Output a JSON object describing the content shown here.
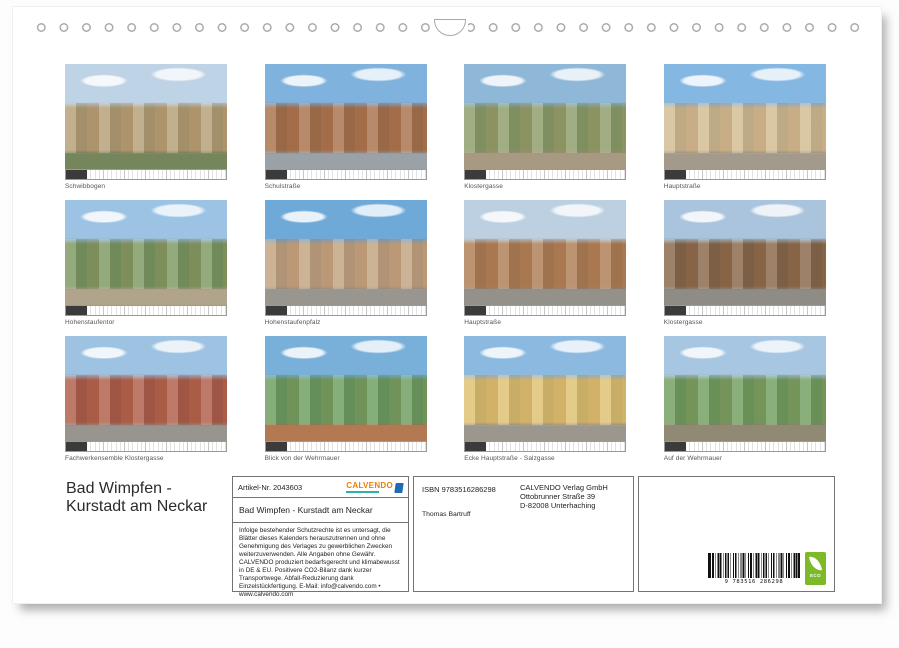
{
  "grid": {
    "items": [
      {
        "caption": "Schwibbogen",
        "palette": [
          "#bfd3e6",
          "#b5a077",
          "#75865c"
        ]
      },
      {
        "caption": "Schulstraße",
        "palette": [
          "#7fb2dd",
          "#a9744f",
          "#9aa2a8"
        ]
      },
      {
        "caption": "Klostergasse",
        "palette": [
          "#8fb8d8",
          "#8f9f6b",
          "#a89a82"
        ]
      },
      {
        "caption": "Hauptstraße",
        "palette": [
          "#85b7e3",
          "#d3bd94",
          "#a39a8c"
        ]
      },
      {
        "caption": "Hohenstaufentor",
        "palette": [
          "#9cc3e4",
          "#7e9a63",
          "#b0a48c"
        ]
      },
      {
        "caption": "Hohenstaufenpfalz",
        "palette": [
          "#6ea9d8",
          "#c4a582",
          "#99958f"
        ]
      },
      {
        "caption": "Hauptstraße",
        "palette": [
          "#bcd0e2",
          "#b08057",
          "#94908a"
        ]
      },
      {
        "caption": "Klostergasse",
        "palette": [
          "#aac4dd",
          "#8a6a4c",
          "#8f8c86"
        ]
      },
      {
        "caption": "Fachwerkensemble Klostergasse",
        "palette": [
          "#9dc2e2",
          "#b2604c",
          "#98948e"
        ]
      },
      {
        "caption": "Blick von der Wehrmauer",
        "palette": [
          "#79b0da",
          "#6f9f62",
          "#b27952"
        ]
      },
      {
        "caption": "Ecke Hauptstraße - Salzgasse",
        "palette": [
          "#8cb9e0",
          "#dfc173",
          "#9b978f"
        ]
      },
      {
        "caption": "Auf der Wehrmauer",
        "palette": [
          "#a7c6e2",
          "#74a061",
          "#908974"
        ]
      }
    ]
  },
  "footer": {
    "title_line1": "Bad Wimpfen -",
    "title_line2": "Kurstadt am Neckar",
    "artikel": "Artikel-Nr. 2043603",
    "logo_text": "CALVENDO",
    "calendar_title": "Bad Wimpfen - Kurstadt am Neckar",
    "legal": "Infolge bestehender Schutzrechte ist es untersagt, die Blätter dieses Kalenders herauszutrennen und ohne Genehmigung des Verlages zu gewerblichen Zwecken weiterzuverwenden. Alle Angaben ohne Gewähr. CALVENDO produziert bedarfsgerecht und klimabewusst in DE & EU. Positivere CO2-Bilanz dank kurzer Transportwege. Abfall-Reduzierung dank Einzelstückfertigung. E-Mail: info@calvendo.com • www.calvendo.com",
    "isbn": "ISBN 9783516286298",
    "publisher_lines": [
      "CALVENDO Verlag GmbH",
      "Ottobrunner Straße 39",
      "D-82008 Unterhaching"
    ],
    "author": "Thomas Bartruff",
    "barcode_digits": "9 783516 286298",
    "eco_label": "ECO"
  },
  "colors": {
    "logo_orange": "#f07d00",
    "logo_teal": "#2ab3a6",
    "logo_blue": "#1f6cb4",
    "eco_green": "#7db928"
  }
}
